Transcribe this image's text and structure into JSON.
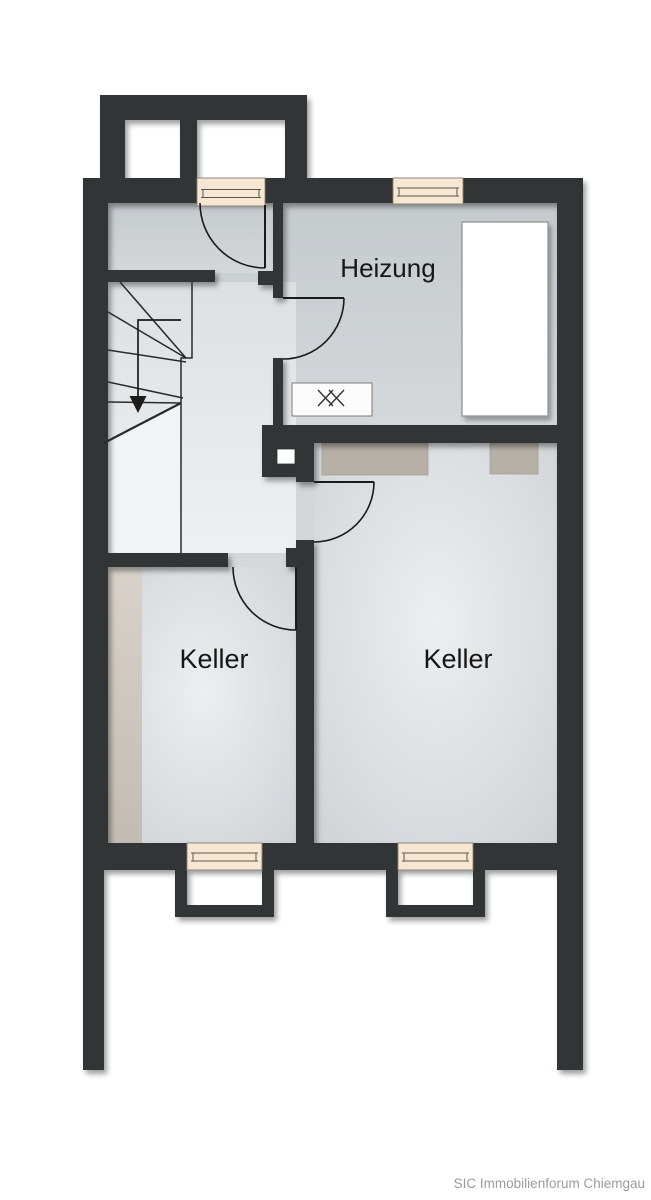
{
  "plan": {
    "type": "basement-floor-plan",
    "rooms": [
      {
        "id": "heizung",
        "label": "Heizung"
      },
      {
        "id": "keller-left",
        "label": "Keller"
      },
      {
        "id": "keller-right",
        "label": "Keller"
      }
    ],
    "attribution": "SIC Immobilienforum Chiemgau",
    "stair": {
      "direction": "down",
      "type": "winder",
      "icon": "down-arrow"
    },
    "symbols": [
      {
        "id": "drain-symbol",
        "glyph": "double-x",
        "location": "heizung"
      },
      {
        "id": "boiler-unit",
        "shape": "white-rectangle",
        "location": "heizung"
      }
    ],
    "windows": {
      "top": 2,
      "bottom": 2,
      "lightwells_bottom": 2,
      "entrance_lightwell_top": true
    },
    "colors": {
      "wall": "#323436",
      "window": "#f7e6d2",
      "furniture": "#b7b0a7",
      "furniture_light": "#d5cfc8",
      "attribution_text": "#9b9b9b",
      "floor_dark": "#c5cacd",
      "floor_light": "#eceeef"
    }
  }
}
